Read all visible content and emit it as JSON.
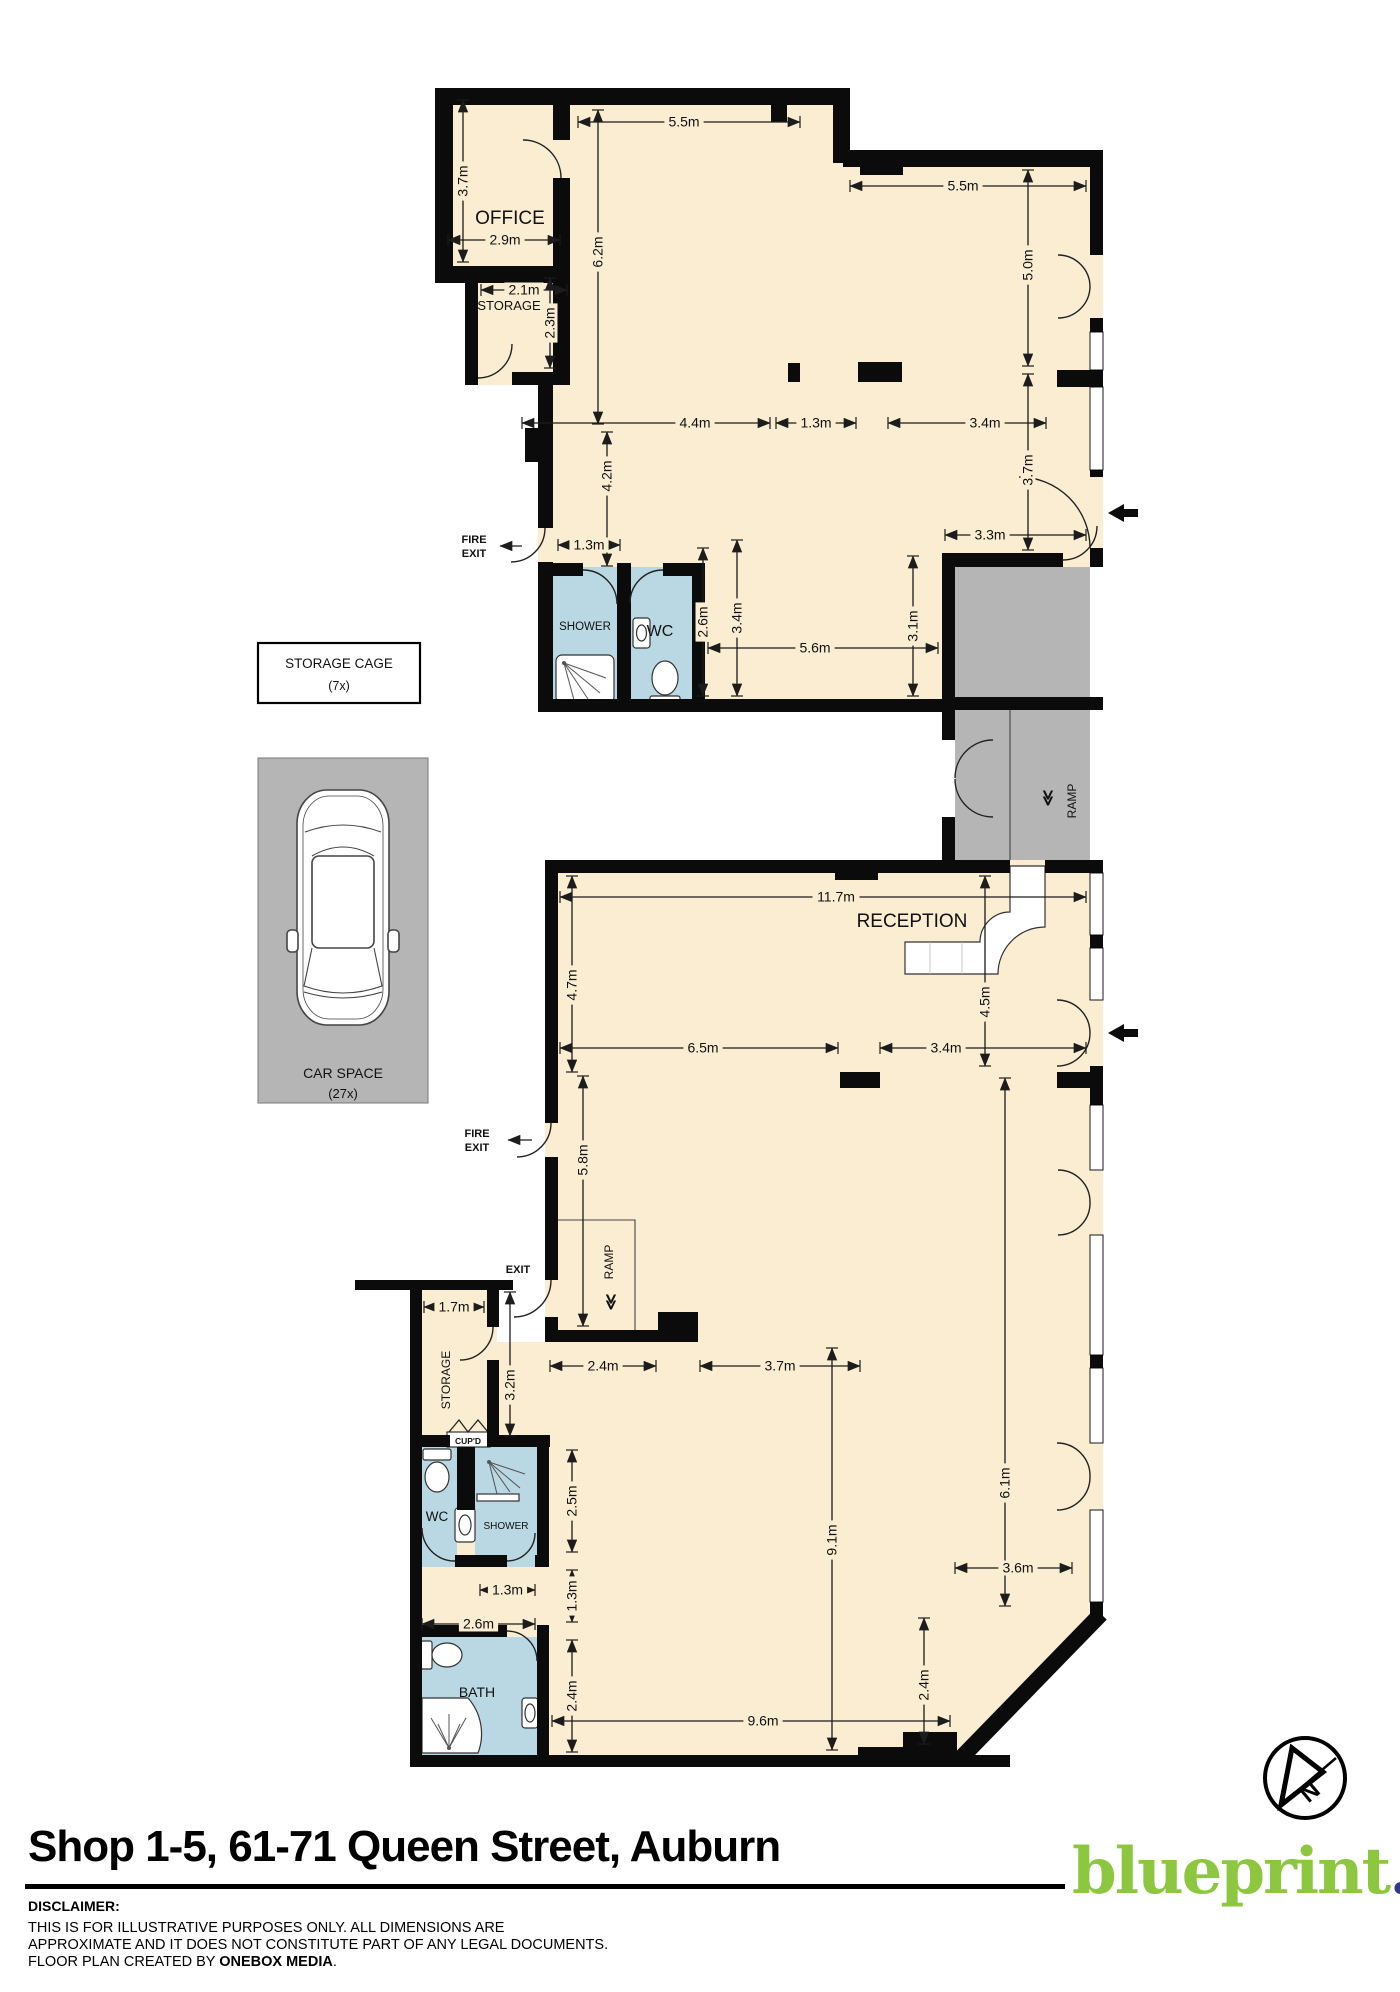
{
  "title": "Shop 1-5, 61-71 Queen Street, Auburn",
  "branding": {
    "logo_text": "blueprint",
    "logo_dot": ".",
    "logo_color": "#8dc63f",
    "logo_dot_color": "#2b3990"
  },
  "disclaimer": {
    "heading": "DISCLAIMER:",
    "line1": "THIS IS FOR ILLUSTRATIVE PURPOSES ONLY. ALL DIMENSIONS ARE",
    "line2": "APPROXIMATE AND IT DOES NOT CONSTITUTE PART OF ANY LEGAL DOCUMENTS.",
    "line3_prefix": "FLOOR PLAN CREATED BY ",
    "line3_bold": "ONEBOX MEDIA",
    "line3_suffix": "."
  },
  "colors": {
    "floor_cream": "#FAEDD2",
    "bathroom_blue": "#B9D8E3",
    "ramp_gray": "#B5B5B5",
    "wall_black": "#0b0b0b"
  },
  "rooms": {
    "office": "OFFICE",
    "storage_top": "STORAGE",
    "shower_top": "SHOWER",
    "wc_top": "WC",
    "reception": "RECEPTION",
    "ramp": "RAMP",
    "storage_bottom": "STORAGE",
    "cupd": "CUP'D",
    "wc_bottom": "WC",
    "shower_bottom": "SHOWER",
    "bath": "BATH"
  },
  "annotations": {
    "fire_exit_line1": "FIRE",
    "fire_exit_line2": "EXIT",
    "exit": "EXIT",
    "storage_cage_line1": "STORAGE CAGE",
    "storage_cage_line2": "(7x)",
    "car_space_line1": "CAR SPACE",
    "car_space_line2": "(27x)",
    "ramp_chevrons": "≪",
    "north": "N"
  },
  "dimensions": [
    {
      "v": "3.7m",
      "o": "v",
      "p": 463,
      "a": 100,
      "b": 262
    },
    {
      "v": "5.5m",
      "o": "h",
      "p": 122,
      "a": 578,
      "b": 800,
      "lx": 684
    },
    {
      "v": "5.5m",
      "o": "h",
      "p": 186,
      "a": 850,
      "b": 1086,
      "lx": 963
    },
    {
      "v": "2.9m",
      "o": "h",
      "p": 240,
      "a": 448,
      "b": 560,
      "lx": 505
    },
    {
      "v": "2.1m",
      "o": "h",
      "p": 290,
      "a": 481,
      "b": 567,
      "lx": 524
    },
    {
      "v": "2.3m",
      "o": "v",
      "p": 550,
      "a": 278,
      "b": 368
    },
    {
      "v": "6.2m",
      "o": "v",
      "p": 598,
      "a": 110,
      "b": 424,
      "ly": 252
    },
    {
      "v": "5.0m",
      "o": "v",
      "p": 1028,
      "a": 170,
      "b": 366,
      "ly": 265
    },
    {
      "v": "4.4m",
      "o": "h",
      "p": 423,
      "a": 522,
      "b": 770,
      "lx": 695
    },
    {
      "v": "1.3m",
      "o": "h",
      "p": 423,
      "a": 776,
      "b": 856
    },
    {
      "v": "3.4m",
      "o": "h",
      "p": 423,
      "a": 888,
      "b": 1046,
      "lx": 985
    },
    {
      "v": "4.2m",
      "o": "v",
      "p": 607,
      "a": 432,
      "b": 566,
      "ly": 476
    },
    {
      "v": "3.7m",
      "o": "v",
      "p": 1028,
      "a": 374,
      "b": 550,
      "ly": 470
    },
    {
      "v": "1.3m",
      "o": "h",
      "p": 545,
      "a": 558,
      "b": 620
    },
    {
      "v": "3.3m",
      "o": "h",
      "p": 535,
      "a": 945,
      "b": 1086,
      "lx": 990
    },
    {
      "v": "2.6m",
      "o": "v",
      "p": 703,
      "a": 548,
      "b": 696
    },
    {
      "v": "3.4m",
      "o": "v",
      "p": 737,
      "a": 540,
      "b": 696
    },
    {
      "v": "3.1m",
      "o": "v",
      "p": 913,
      "a": 556,
      "b": 696
    },
    {
      "v": "5.6m",
      "o": "h",
      "p": 648,
      "a": 708,
      "b": 938,
      "lx": 815
    },
    {
      "v": "11.7m",
      "o": "h",
      "p": 897,
      "a": 560,
      "b": 1086,
      "lx": 836
    },
    {
      "v": "4.7m",
      "o": "v",
      "p": 572,
      "a": 876,
      "b": 1072,
      "ly": 985
    },
    {
      "v": "4.5m",
      "o": "v",
      "p": 985,
      "a": 876,
      "b": 1066,
      "ly": 1002
    },
    {
      "v": "6.5m",
      "o": "h",
      "p": 1048,
      "a": 560,
      "b": 838,
      "lx": 703
    },
    {
      "v": "3.4m",
      "o": "h",
      "p": 1048,
      "a": 880,
      "b": 1086,
      "lx": 946
    },
    {
      "v": "5.8m",
      "o": "v",
      "p": 583,
      "a": 1076,
      "b": 1326,
      "ly": 1160
    },
    {
      "v": "2.4m",
      "o": "h",
      "p": 1366,
      "a": 550,
      "b": 656
    },
    {
      "v": "3.7m",
      "o": "h",
      "p": 1366,
      "a": 700,
      "b": 860,
      "lx": 780
    },
    {
      "v": "3.2m",
      "o": "v",
      "p": 510,
      "a": 1292,
      "b": 1436,
      "ly": 1385
    },
    {
      "v": "1.7m",
      "o": "h",
      "p": 1307,
      "a": 424,
      "b": 484
    },
    {
      "v": "2.5m",
      "o": "v",
      "p": 572,
      "a": 1450,
      "b": 1552
    },
    {
      "v": "1.3m",
      "o": "v",
      "p": 572,
      "a": 1570,
      "b": 1622
    },
    {
      "v": "2.4m",
      "o": "v",
      "p": 572,
      "a": 1640,
      "b": 1752
    },
    {
      "v": "1.3m",
      "o": "h",
      "p": 1590,
      "a": 480,
      "b": 535
    },
    {
      "v": "2.6m",
      "o": "h",
      "p": 1624,
      "a": 422,
      "b": 535
    },
    {
      "v": "9.1m",
      "o": "v",
      "p": 832,
      "a": 1348,
      "b": 1750,
      "ly": 1540
    },
    {
      "v": "6.1m",
      "o": "v",
      "p": 1005,
      "a": 1078,
      "b": 1606,
      "ly": 1483
    },
    {
      "v": "3.6m",
      "o": "h",
      "p": 1568,
      "a": 955,
      "b": 1072,
      "lx": 1018
    },
    {
      "v": "2.4m",
      "o": "v",
      "p": 924,
      "a": 1618,
      "b": 1744,
      "ly": 1685
    },
    {
      "v": "9.6m",
      "o": "h",
      "p": 1721,
      "a": 552,
      "b": 950,
      "lx": 763
    }
  ]
}
